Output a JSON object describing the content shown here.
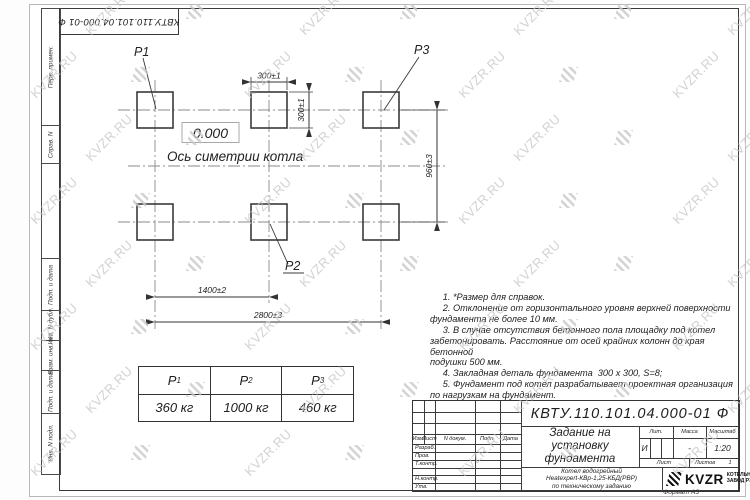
{
  "doc": {
    "number": "КВТУ.110.101.04.000-01  Ф"
  },
  "watermark": {
    "text": "KVZR.RU"
  },
  "side_strip": {
    "labels": [
      "Перв. примен.",
      "Справ. N",
      "Подп. и дата",
      "Инв. N дубл.",
      "Взам. инв. N",
      "Подп. и дата",
      "Инв. N подл."
    ]
  },
  "drawing": {
    "point_labels": {
      "p1": "P1",
      "p2": "P2",
      "p3": "P3"
    },
    "elevation": "0.000",
    "axis_label": "Ось симетрии котла",
    "dimensions": {
      "pad_width": "300±1",
      "pad_height": "300±1",
      "row_spacing": "960±3",
      "mid_spacing": "1400±2",
      "overall": "2800±3"
    }
  },
  "loads_table": {
    "headers": [
      {
        "p": "P",
        "sub": "1"
      },
      {
        "p": "P",
        "sub": "2"
      },
      {
        "p": "P",
        "sub": "3"
      }
    ],
    "values": [
      "360  кг",
      "1000  кг",
      "460  кг"
    ]
  },
  "notes": {
    "lines": [
      "     1. *Размер для справок.",
      "     2. Отклонение от горизонтального уровня верхней поверхности",
      "фундамента не более 10 мм.",
      "     3. В случае отсутствия бетонного пола площадку под котел",
      "забетонировать. Расстояние от осей крайних колонн до края бетонной",
      "подушки 500 мм.",
      "     4. Закладная деталь фундамента  300 x 300, S=8;",
      "     5. Фундамент под котел разрабатывает проектная организация",
      "по нагрузкам на фундамент."
    ]
  },
  "title_block": {
    "doc_number": "КВТУ.110.101.04.000-01  Ф",
    "title_lines": [
      "Задание на",
      "установку",
      "фундамента"
    ],
    "subject_lines": [
      "Котел водогрейный",
      "Heatexpert-КВр-1,25-КБД(РВР)",
      "по техническому заданию"
    ],
    "col_headers": [
      "Изм.",
      "Лист",
      "N докум.",
      "Подп.",
      "Дата"
    ],
    "row_labels": [
      "Разраб.",
      "Пров.",
      "Т.контр.",
      "Н.контр.",
      "Утв."
    ],
    "lit_header": "Лит.",
    "mass_header": "Масса",
    "scale_header": "Масштаб",
    "lit_value": "И",
    "mass_value": "-",
    "scale_value": "1:20",
    "sheet_label": "Лист",
    "sheets_label": "Листов",
    "sheets_value": "1",
    "logo_text": "KVZR",
    "company_lines": [
      "КОТЕЛЬНЫЙ",
      "ЗАВОД РЭП"
    ],
    "format_label": "Формат А3"
  }
}
